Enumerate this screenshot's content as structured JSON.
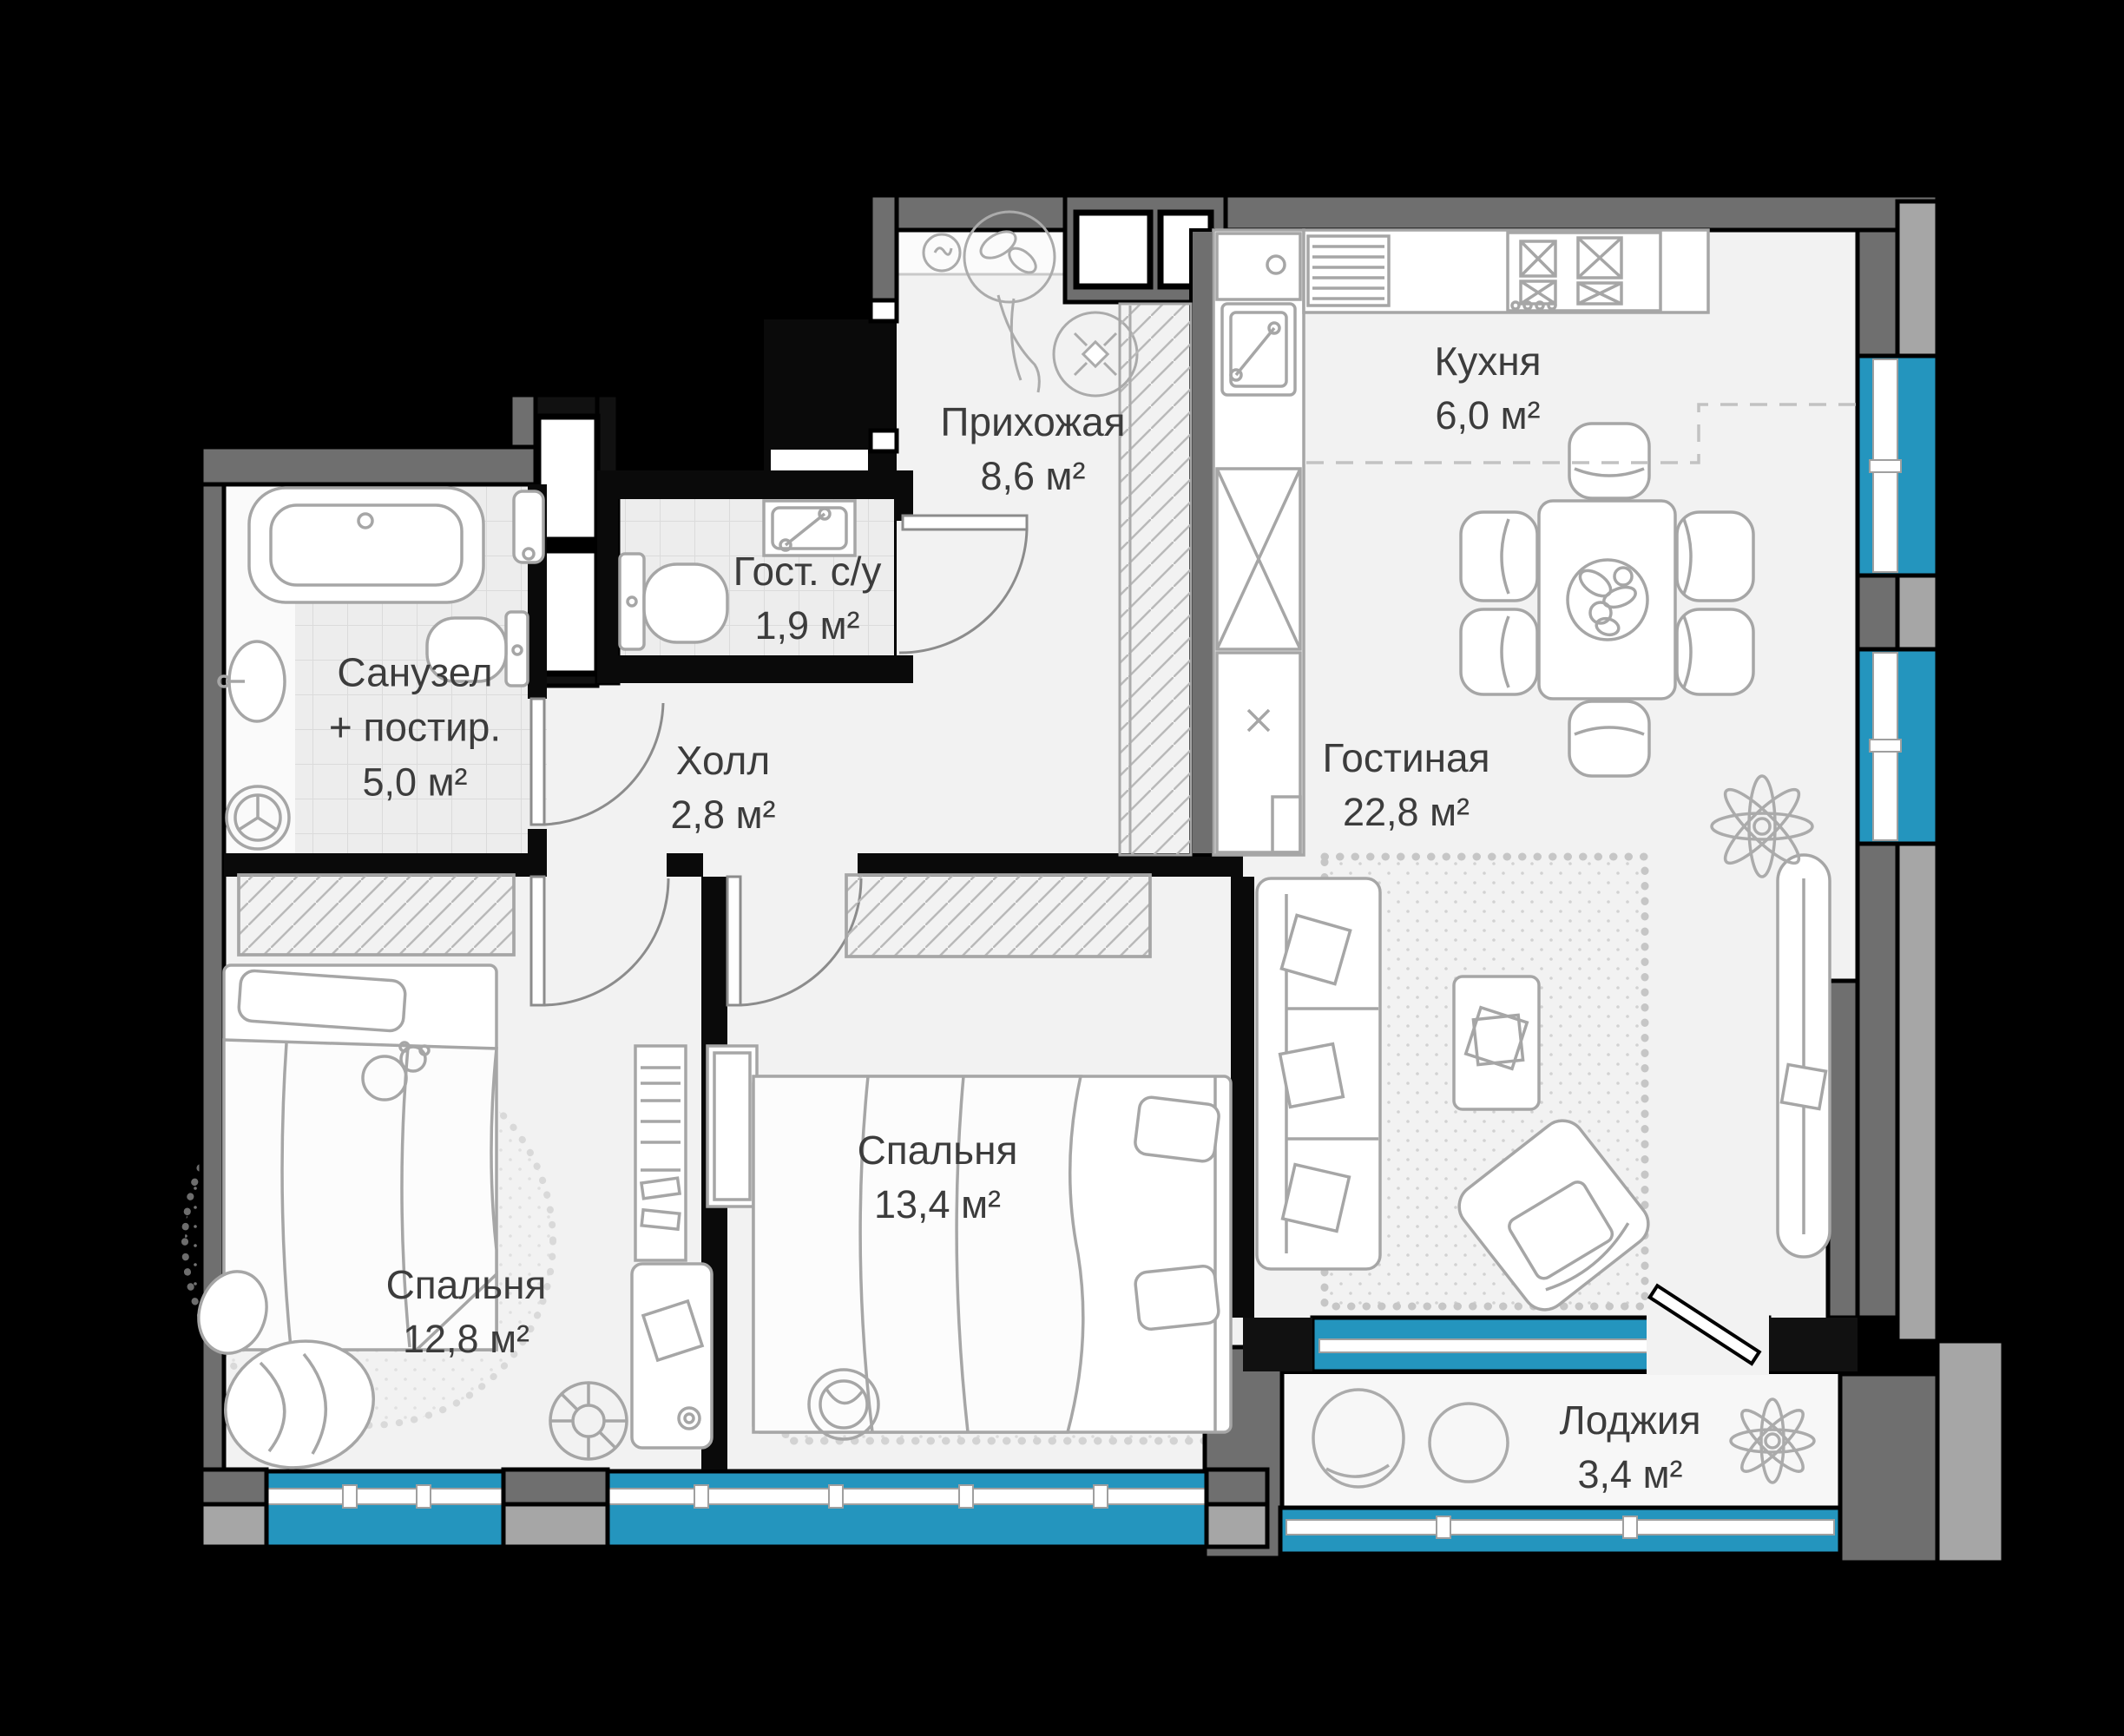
{
  "floor_plan": {
    "type": "apartment-floor-plan",
    "rooms": [
      {
        "id": "prihozhaya",
        "name": "Прихожая",
        "area": "8,6 м²"
      },
      {
        "id": "kitchen",
        "name": "Кухня",
        "area": "6,0 м²"
      },
      {
        "id": "guest-wc",
        "name": "Гост. с/у",
        "area": "1,9 м²"
      },
      {
        "id": "bathroom",
        "name": "Санузел",
        "name_line2": "+ постир.",
        "area": "5,0 м²"
      },
      {
        "id": "hall",
        "name": "Холл",
        "area": "2,8 м²"
      },
      {
        "id": "living-room",
        "name": "Гостиная",
        "area": "22,8 м²"
      },
      {
        "id": "bedroom-1",
        "name": "Спальня",
        "area": "12,8 м²"
      },
      {
        "id": "bedroom-2",
        "name": "Спальня",
        "area": "13,4 м²"
      },
      {
        "id": "loggia",
        "name": "Лоджия",
        "area": "3,4 м²"
      }
    ],
    "colors": {
      "background": "#000000",
      "window_glass": "#2495BE",
      "wall_dark": "#6F6F6F",
      "wall_light": "#A6A6A6",
      "floor": "#F2F2F2",
      "tile": "#EDEDED",
      "furniture_line": "#A6A6A6",
      "label_text": "#3C3C3C"
    }
  }
}
